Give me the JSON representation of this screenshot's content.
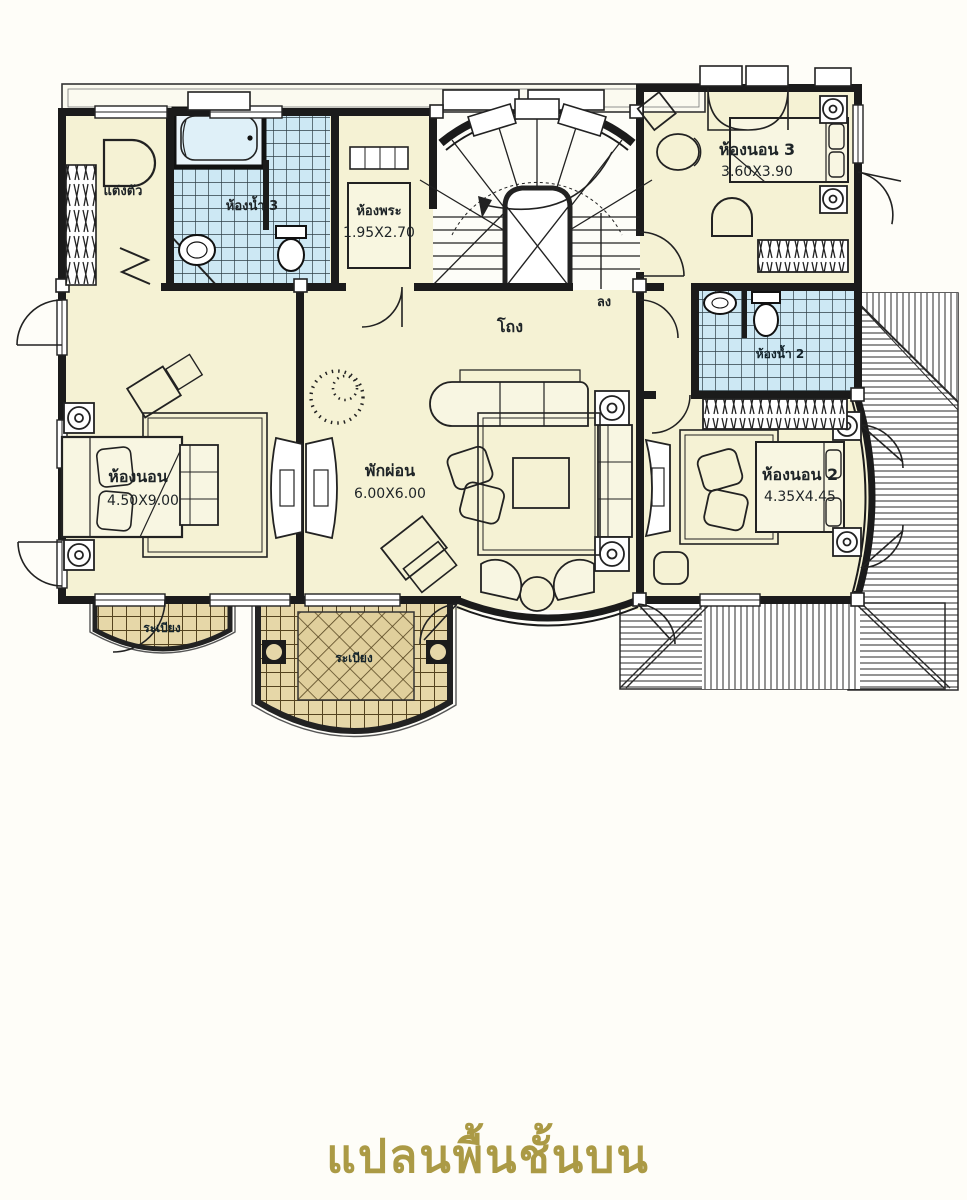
{
  "title": {
    "text": "แปลนพื้นชั้นบน"
  },
  "labels": {
    "dressing": "แต่งตัว",
    "bath3": "ห้องน้ำ 3",
    "prayer_room": "ห้องพระ",
    "prayer_dims": "1.95X2.70",
    "bedroom3": "ห้องนอน 3",
    "bedroom3_dims": "3.60X3.90",
    "down": "ลง",
    "hall": "โถง",
    "master_bedroom": "ห้องนอน",
    "master_dims": "4.50X9.00",
    "lounge": "พักผ่อน",
    "lounge_dims": "6.00X6.00",
    "bedroom2": "ห้องนอน 2",
    "bedroom2_dims": "4.35X4.45",
    "bath2": "ห้องน้ำ 2",
    "balcony_small": "ระเบียง",
    "balcony_large": "ระเบียง"
  },
  "colors": {
    "room_fill": "#f5f2d4",
    "bath_tile": "#cde8f4",
    "balcony_tile": "#e6d7a8",
    "wall": "#1b1b1b",
    "title_gold": "#ab9a45"
  }
}
